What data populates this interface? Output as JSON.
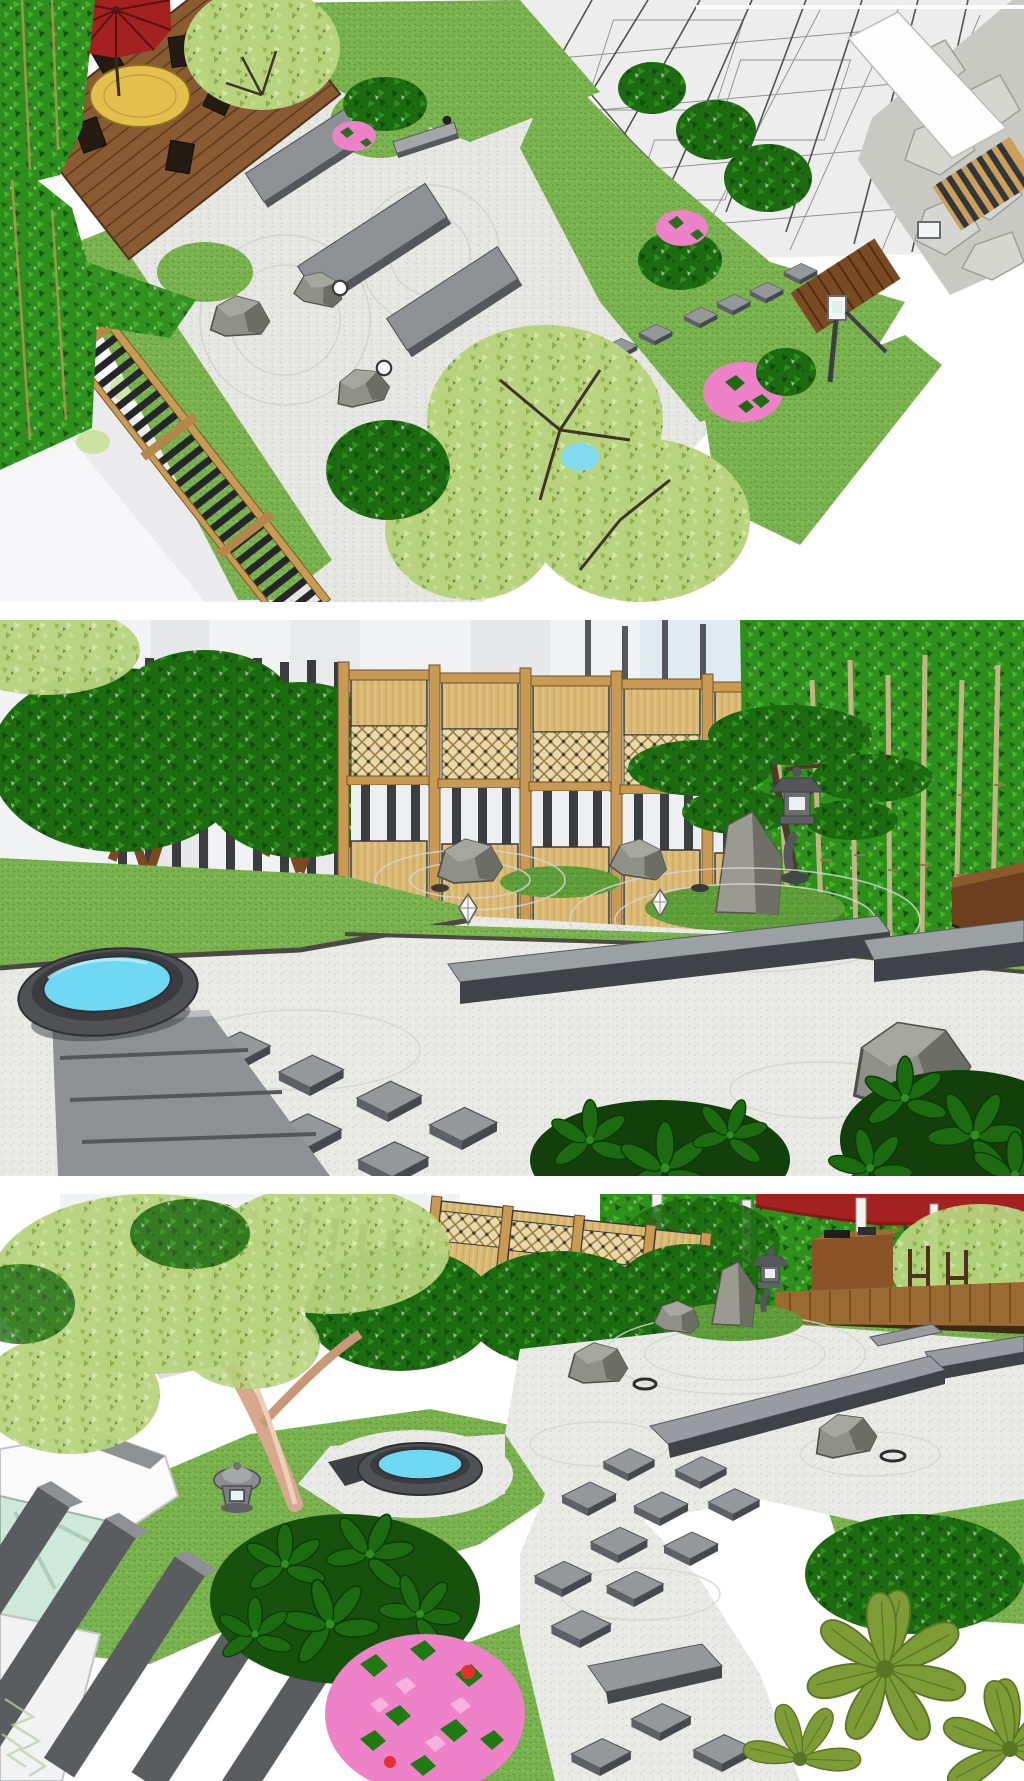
{
  "page": {
    "type": "image-collage",
    "background": "#ffffff",
    "panel_count": 3
  },
  "palette": {
    "umbrella_red": "#a32121",
    "umbrella_red_dark": "#871717",
    "water_cyan": "#6fd8f2",
    "lawn_green": "#79b24e",
    "moss_green": "#5f9e3a",
    "gravel_light": "#e6e6e3",
    "slab_top": "#8d9194",
    "slab_side": "#4c5054",
    "deck_brown": "#8a5a33",
    "counter_brown": "#8a5427",
    "screen_tan": "#d9b974",
    "lattice_tan": "#ead9a8",
    "rail_tan": "#c89a53",
    "fence_black": "#2a2a2e",
    "sky_blue": "#e0ebf2",
    "wall_white": "#f1f2f3",
    "foliage_dark": "#1d6b10",
    "foliage_darker": "#0e4d07",
    "foliage_light": "#b7d37e",
    "bamboo_green": "#2f8f1c",
    "culm_tan": "#c9b889",
    "azalea_pink": "#ee82c8",
    "schefflera_olive": "#7d9c35",
    "rock_gray": "#8f9088",
    "trunk_brown": "#7a4a20",
    "maple_trunk_pink": "#d8a88e",
    "basin_gray": "#4f5154",
    "glass_mint": "#cfe8dc",
    "street_gray": "#ebebee"
  },
  "panels": [
    {
      "id": "panel-1",
      "view": "aerial-view",
      "label": "Aerial 3D rendering of a courtyard zen garden with wooden deck, red umbrella, gravel field, stone slabs and wireframe house",
      "elements": [
        "red-umbrella",
        "dining-set",
        "wood-deck",
        "bamboo-hedge",
        "slat-fence",
        "zen-gravel",
        "stone-slab-path",
        "stepping-stones",
        "garden-rocks",
        "sphere-lights",
        "planting-islands",
        "stone-bench",
        "azalea-bushes",
        "maple-trees",
        "wireframe-house",
        "flagstone-path",
        "white-walkway",
        "lawn",
        "post-light",
        "street"
      ]
    },
    {
      "id": "panel-2",
      "view": "ground-view",
      "label": "Eye-level 3D rendering of the zen garden with bamboo screen fence, stone lantern, standing stone, plank benches, stepping stones and round water basin",
      "elements": [
        "screen-fence",
        "pole-fence",
        "hedge-trees",
        "bamboo-grove",
        "pine-tree",
        "stone-lantern",
        "standing-stone",
        "moss-mound",
        "garden-rocks",
        "plank-benches",
        "stepping-stones",
        "water-basin",
        "stone-walkway",
        "lawn",
        "zen-gravel",
        "schefflera-shrubs",
        "sky"
      ]
    },
    {
      "id": "panel-3",
      "view": "elevated-view",
      "label": "Elevated 3D rendering of the zen garden with maple tree, screen fence, lanterns, water basin, azalea, schefflera plants and modern pillar gate",
      "elements": [
        "maple-tree",
        "screen-fence",
        "pole-fence",
        "shrub-row",
        "zen-gravel",
        "standing-stone",
        "stone-lantern",
        "garden-rocks",
        "plank-benches",
        "stepping-stones",
        "water-basin",
        "lawn-lantern",
        "gate-structure",
        "pillar-fence",
        "schefflera-dark-bush",
        "azalea-bush",
        "big-schefflera",
        "deck-terrace",
        "counter-box",
        "red-umbrella-edge",
        "lawn",
        "leaf-sketch"
      ]
    }
  ]
}
